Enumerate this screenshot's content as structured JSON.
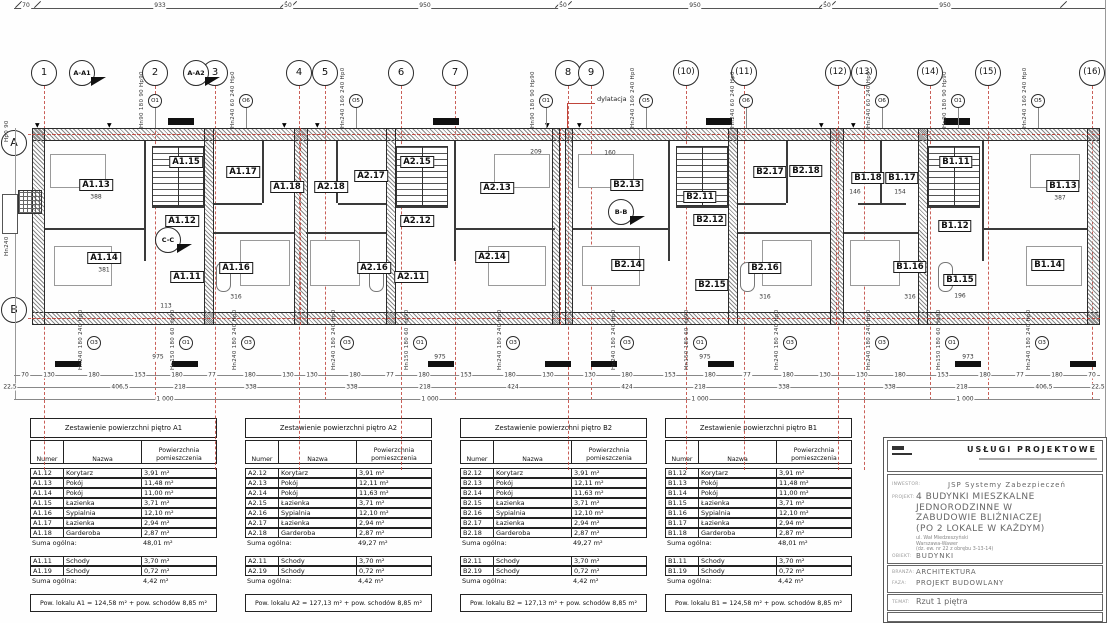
{
  "drawing": {
    "dims_top": {
      "ticks": [
        18,
        37,
        283,
        293,
        558,
        568,
        822,
        832,
        1063
      ],
      "labels": [
        {
          "t": "70",
          "x": 26
        },
        {
          "t": "933",
          "x": 160
        },
        {
          "t": "50",
          "x": 288
        },
        {
          "t": "950",
          "x": 425
        },
        {
          "t": "50",
          "x": 563
        },
        {
          "t": "950",
          "x": 695
        },
        {
          "t": "50",
          "x": 827
        },
        {
          "t": "950",
          "x": 945
        }
      ]
    },
    "grid_bubbles": [
      {
        "t": "1",
        "x": 44,
        "ext": 1
      },
      {
        "t": "2",
        "x": 155
      },
      {
        "t": "3",
        "x": 215,
        "ext": 1
      },
      {
        "t": "4",
        "x": 299,
        "ext": 1
      },
      {
        "t": "5",
        "x": 325
      },
      {
        "t": "6",
        "x": 401,
        "ext": 1
      },
      {
        "t": "7",
        "x": 455
      },
      {
        "t": "8",
        "x": 568,
        "ext": 1
      },
      {
        "t": "9",
        "x": 591
      },
      {
        "t": "(10)",
        "x": 686,
        "ext": 1
      },
      {
        "t": "(11)",
        "x": 744,
        "ext": 1
      },
      {
        "t": "(12)",
        "x": 838,
        "ext": 1
      },
      {
        "t": "(13)",
        "x": 864,
        "ext": 1
      },
      {
        "t": "(14)",
        "x": 930
      },
      {
        "t": "(15)",
        "x": 988
      },
      {
        "t": "(16)",
        "x": 1092
      }
    ],
    "row_bubbles": [
      {
        "t": "A",
        "y": 143,
        "line_y": 134
      },
      {
        "t": "B",
        "y": 310,
        "line_y": 318
      }
    ],
    "section_markers": [
      {
        "t": "A-A1",
        "x": 82,
        "y": 73
      },
      {
        "t": "A-A2",
        "x": 196,
        "y": 73
      },
      {
        "t": "B-B",
        "x": 621,
        "y": 212
      },
      {
        "t": "C-C",
        "x": 168,
        "y": 240
      }
    ],
    "dylatacja": {
      "t": "dylatacja",
      "x": 597,
      "y": 95
    },
    "room_labels": [
      {
        "t": "A1.13",
        "x": 96,
        "y": 185
      },
      {
        "t": "A1.15",
        "x": 186,
        "y": 162
      },
      {
        "t": "A1.17",
        "x": 243,
        "y": 172
      },
      {
        "t": "A1.18",
        "x": 287,
        "y": 187
      },
      {
        "t": "A1.12",
        "x": 182,
        "y": 221
      },
      {
        "t": "A1.14",
        "x": 104,
        "y": 258
      },
      {
        "t": "A1.11",
        "x": 187,
        "y": 277
      },
      {
        "t": "A1.16",
        "x": 236,
        "y": 268
      },
      {
        "t": "A2.18",
        "x": 331,
        "y": 187
      },
      {
        "t": "A2.17",
        "x": 371,
        "y": 176
      },
      {
        "t": "A2.15",
        "x": 417,
        "y": 162
      },
      {
        "t": "A2.13",
        "x": 497,
        "y": 188
      },
      {
        "t": "A2.12",
        "x": 417,
        "y": 221
      },
      {
        "t": "A2.16",
        "x": 374,
        "y": 268
      },
      {
        "t": "A2.11",
        "x": 411,
        "y": 277
      },
      {
        "t": "A2.14",
        "x": 492,
        "y": 257
      },
      {
        "t": "B2.13",
        "x": 627,
        "y": 185
      },
      {
        "t": "B2.11",
        "x": 700,
        "y": 197
      },
      {
        "t": "B2.17",
        "x": 770,
        "y": 172
      },
      {
        "t": "B2.18",
        "x": 806,
        "y": 171
      },
      {
        "t": "B2.12",
        "x": 710,
        "y": 220
      },
      {
        "t": "B2.14",
        "x": 628,
        "y": 265
      },
      {
        "t": "B2.15",
        "x": 712,
        "y": 285
      },
      {
        "t": "B2.16",
        "x": 765,
        "y": 268
      },
      {
        "t": "B1.18",
        "x": 868,
        "y": 178
      },
      {
        "t": "B1.17",
        "x": 902,
        "y": 178
      },
      {
        "t": "B1.11",
        "x": 956,
        "y": 162
      },
      {
        "t": "B1.13",
        "x": 1063,
        "y": 186
      },
      {
        "t": "B1.12",
        "x": 955,
        "y": 226
      },
      {
        "t": "B1.16",
        "x": 910,
        "y": 267
      },
      {
        "t": "B1.15",
        "x": 960,
        "y": 280
      },
      {
        "t": "B1.14",
        "x": 1048,
        "y": 265
      }
    ],
    "window_markers_top": [
      {
        "o": "O1",
        "t": "Hn90 180 90 Hp90",
        "x": 155
      },
      {
        "o": "O6",
        "t": "Hn240 60 240 Hp0",
        "x": 246
      },
      {
        "o": "O5",
        "t": "Hn240 160 240 Hp0",
        "x": 356
      },
      {
        "o": "O1",
        "t": "Hn90 180 90 Hp90",
        "x": 546
      },
      {
        "o": "O5",
        "t": "Hn240 160 240 Hp0",
        "x": 646
      },
      {
        "o": "O6",
        "t": "Hn240 60 240 Hp0",
        "x": 746
      },
      {
        "o": "O6",
        "t": "Hn240 60 240 Hp0",
        "x": 882
      },
      {
        "o": "O1",
        "t": "Hn90 180 90 Hp90",
        "x": 958
      },
      {
        "o": "O5",
        "t": "Hn240 160 240 Hp0",
        "x": 1038
      }
    ],
    "window_markers_bottom": [
      {
        "o": "O3",
        "t": "Hn240 180 240 Hp0",
        "x": 94
      },
      {
        "o": "O1",
        "t": "Hn150 180 60 Hp90",
        "x": 186
      },
      {
        "o": "O3",
        "t": "Hn240 180 240 Hp0",
        "x": 248
      },
      {
        "o": "O3",
        "t": "Hn240 180 240 Hp0",
        "x": 347
      },
      {
        "o": "O1",
        "t": "Hn150 180 60 Hp90",
        "x": 420
      },
      {
        "o": "O3",
        "t": "Hn240 180 240 Hp0",
        "x": 513
      },
      {
        "o": "O3",
        "t": "Hn240 180 240 Hp0",
        "x": 627
      },
      {
        "o": "O1",
        "t": "Hn150 180 60 Hp90",
        "x": 700
      },
      {
        "o": "O3",
        "t": "Hn240 180 240 Hp0",
        "x": 790
      },
      {
        "o": "O3",
        "t": "Hn240 180 240 Hp0",
        "x": 882
      },
      {
        "o": "O1",
        "t": "Hn150 180 60 Hp90",
        "x": 952
      },
      {
        "o": "O3",
        "t": "Hn240 180 240 Hp0",
        "x": 1042
      }
    ],
    "dim_row1": [
      [
        "70",
        25
      ],
      [
        "130",
        49
      ],
      [
        "180",
        94
      ],
      [
        "153",
        140
      ],
      [
        "180",
        177
      ],
      [
        "77",
        212
      ],
      [
        "180",
        250
      ],
      [
        "130",
        288
      ],
      [
        "130",
        312
      ],
      [
        "180",
        355
      ],
      [
        "77",
        390
      ],
      [
        "180",
        424
      ],
      [
        "153",
        466
      ],
      [
        "180",
        510
      ],
      [
        "130",
        548
      ],
      [
        "130",
        590
      ],
      [
        "180",
        627
      ],
      [
        "153",
        670
      ],
      [
        "180",
        710
      ],
      [
        "77",
        747
      ],
      [
        "180",
        788
      ],
      [
        "130",
        825
      ],
      [
        "130",
        862
      ],
      [
        "180",
        900
      ],
      [
        "153",
        943
      ],
      [
        "180",
        985
      ],
      [
        "77",
        1020
      ],
      [
        "180",
        1057
      ],
      [
        "70",
        1092
      ]
    ],
    "dim_row2": [
      [
        "22,5",
        10
      ],
      [
        "406,5",
        120
      ],
      [
        "218",
        180
      ],
      [
        "338",
        251
      ],
      [
        "338",
        352
      ],
      [
        "218",
        425
      ],
      [
        "424",
        513
      ],
      [
        "424",
        627
      ],
      [
        "218",
        700
      ],
      [
        "338",
        784
      ],
      [
        "338",
        890
      ],
      [
        "218",
        962
      ],
      [
        "406,5",
        1044
      ],
      [
        "22,5",
        1098
      ]
    ],
    "dim_row3": [
      [
        "1 000",
        165
      ],
      [
        "1 000",
        430
      ],
      [
        "1 000",
        700
      ],
      [
        "1 000",
        965
      ]
    ],
    "dim_975": [
      [
        "975",
        158
      ],
      [
        "975",
        440
      ],
      [
        "975",
        705
      ],
      [
        "973",
        968
      ]
    ],
    "inner_dims": [
      [
        "388",
        96,
        197
      ],
      [
        "381",
        104,
        270
      ],
      [
        "316",
        236,
        297
      ],
      [
        "113",
        166,
        306
      ],
      [
        "209",
        536,
        152
      ],
      [
        "160",
        610,
        153
      ],
      [
        "316",
        765,
        297
      ],
      [
        "387",
        1060,
        198
      ],
      [
        "316",
        910,
        297
      ],
      [
        "196",
        960,
        296
      ],
      [
        "146",
        855,
        192
      ],
      [
        "154",
        900,
        192
      ]
    ],
    "left_labels": [
      {
        "t": "Hn240",
        "x": 4,
        "y": 222
      },
      {
        "t": "Hp0 90",
        "x": 4,
        "y": 108
      }
    ]
  },
  "tables": [
    {
      "unit": "A1",
      "x": 30,
      "title": "Zestawienie powierzchni piętro A1",
      "col_numer": "Numer",
      "col_nazwa": "Nazwa",
      "col_pow1": "Powierzchnia",
      "col_pow2": "pomieszczenia",
      "rooms": [
        [
          "A1.12",
          "Korytarz",
          "3,91 m²"
        ],
        [
          "A1.13",
          "Pokój",
          "11,48 m²"
        ],
        [
          "A1.14",
          "Pokój",
          "11,00 m²"
        ],
        [
          "A1.15",
          "Łazienka",
          "3,71 m²"
        ],
        [
          "A1.16",
          "Sypialnia",
          "12,10 m²"
        ],
        [
          "A1.17",
          "Łazienka",
          "2,94 m²"
        ],
        [
          "A1.18",
          "Garderoba",
          "2,87 m²"
        ]
      ],
      "suma_label": "Suma ogólna:",
      "rooms_suma": "48,01 m²",
      "stairs": [
        [
          "A1.11",
          "Schody",
          "3,70 m²"
        ],
        [
          "A1.19",
          "Schody",
          "0,72 m²"
        ]
      ],
      "stairs_suma": "4,42 m²",
      "footer": "Pow. lokalu A1 = 124,58 m² + pow. schodów 8,85 m²"
    },
    {
      "unit": "A2",
      "x": 245,
      "title": "Zestawienie powierzchni piętro A2",
      "col_numer": "Numer",
      "col_nazwa": "Nazwa",
      "col_pow1": "Powierzchnia",
      "col_pow2": "pomieszczenia",
      "rooms": [
        [
          "A2.12",
          "Korytarz",
          "3,91 m²"
        ],
        [
          "A2.13",
          "Pokój",
          "12,11 m²"
        ],
        [
          "A2.14",
          "Pokój",
          "11,63 m²"
        ],
        [
          "A2.15",
          "Łazienka",
          "3,71 m²"
        ],
        [
          "A2.16",
          "Sypialnia",
          "12,10 m²"
        ],
        [
          "A2.17",
          "Łazienka",
          "2,94 m²"
        ],
        [
          "A2.18",
          "Garderoba",
          "2,87 m²"
        ]
      ],
      "suma_label": "Suma ogólna:",
      "rooms_suma": "49,27 m²",
      "stairs": [
        [
          "A2.11",
          "Schody",
          "3,70 m²"
        ],
        [
          "A2.19",
          "Schody",
          "0,72 m²"
        ]
      ],
      "stairs_suma": "4,42 m²",
      "footer": "Pow. lokalu A2 = 127,13 m² + pow. schodów 8,85 m²"
    },
    {
      "unit": "B2",
      "x": 460,
      "title": "Zestawienie powierzchni piętro B2",
      "col_numer": "Numer",
      "col_nazwa": "Nazwa",
      "col_pow1": "Powierzchnia",
      "col_pow2": "pomieszczenia",
      "rooms": [
        [
          "B2.12",
          "Korytarz",
          "3,91 m²"
        ],
        [
          "B2.13",
          "Pokój",
          "12,11 m²"
        ],
        [
          "B2.14",
          "Pokój",
          "11,63 m²"
        ],
        [
          "B2.15",
          "Łazienka",
          "3,71 m²"
        ],
        [
          "B2.16",
          "Sypialnia",
          "12,10 m²"
        ],
        [
          "B2.17",
          "Łazienka",
          "2,94 m²"
        ],
        [
          "B2.18",
          "Garderoba",
          "2,87 m²"
        ]
      ],
      "suma_label": "Suma ogólna:",
      "rooms_suma": "49,27 m²",
      "stairs": [
        [
          "B2.11",
          "Schody",
          "3,70 m²"
        ],
        [
          "B2.19",
          "Schody",
          "0,72 m²"
        ]
      ],
      "stairs_suma": "4,42 m²",
      "footer": "Pow. lokalu B2 = 127,13 m² + pow. schodów 8,85 m²"
    },
    {
      "unit": "B1",
      "x": 665,
      "title": "Zestawienie powierzchni piętro B1",
      "col_numer": "Numer",
      "col_nazwa": "Nazwa",
      "col_pow1": "Powierzchnia",
      "col_pow2": "pomieszczenia",
      "rooms": [
        [
          "B1.12",
          "Korytarz",
          "3,91 m²"
        ],
        [
          "B1.13",
          "Pokój",
          "11,48 m²"
        ],
        [
          "B1.14",
          "Pokój",
          "11,00 m²"
        ],
        [
          "B1.15",
          "Łazienka",
          "3,71 m²"
        ],
        [
          "B1.16",
          "Sypialnia",
          "12,10 m²"
        ],
        [
          "B1.17",
          "Łazienka",
          "2,94 m²"
        ],
        [
          "B1.18",
          "Garderoba",
          "2,87 m²"
        ]
      ],
      "suma_label": "Suma ogólna:",
      "rooms_suma": "48,01 m²",
      "stairs": [
        [
          "B1.11",
          "Schody",
          "3,70 m²"
        ],
        [
          "B1.19",
          "Schody",
          "0,72 m²"
        ]
      ],
      "stairs_suma": "4,42 m²",
      "footer": "Pow. lokalu B1 = 124,58 m² + pow. schodów 8,85 m²"
    }
  ],
  "title_block": {
    "header": "USŁUGI PROJEKTOWE",
    "inwestor_label": "INWESTOR:",
    "inwestor": "JSP Systemy Zabezpieczeń",
    "projekt_label": "PROJEKT:",
    "projekt_1": "4 BUDYNKI MIESZKALNE",
    "projekt_2": "JEDNORODZINNE W",
    "projekt_3": "ZABUDOWIE BLIŹNIACZEJ",
    "projekt_4": "(PO 2 LOKALE W KAŻDYM)",
    "addr_1": "ul. Wał Miedzeszyński",
    "addr_2": "Warszawa-Wawer",
    "addr_3": "(dz. ew. nr 22 z obrębu 3-13-14)",
    "obiekt_label": "OBIEKT:",
    "obiekt": "BUDYNKI",
    "branza_label": "BRANŻA:",
    "branza": "ARCHITEKTURA",
    "faza_label": "FAZA:",
    "faza": "PROJEKT BUDOWLANY",
    "temat_label": "TEMAT:",
    "temat": "Rzut 1 piętra"
  },
  "colors": {
    "red_line": "#c0443a",
    "wall_hatch": "#8a8a8a",
    "ink": "#1a1a1a"
  }
}
